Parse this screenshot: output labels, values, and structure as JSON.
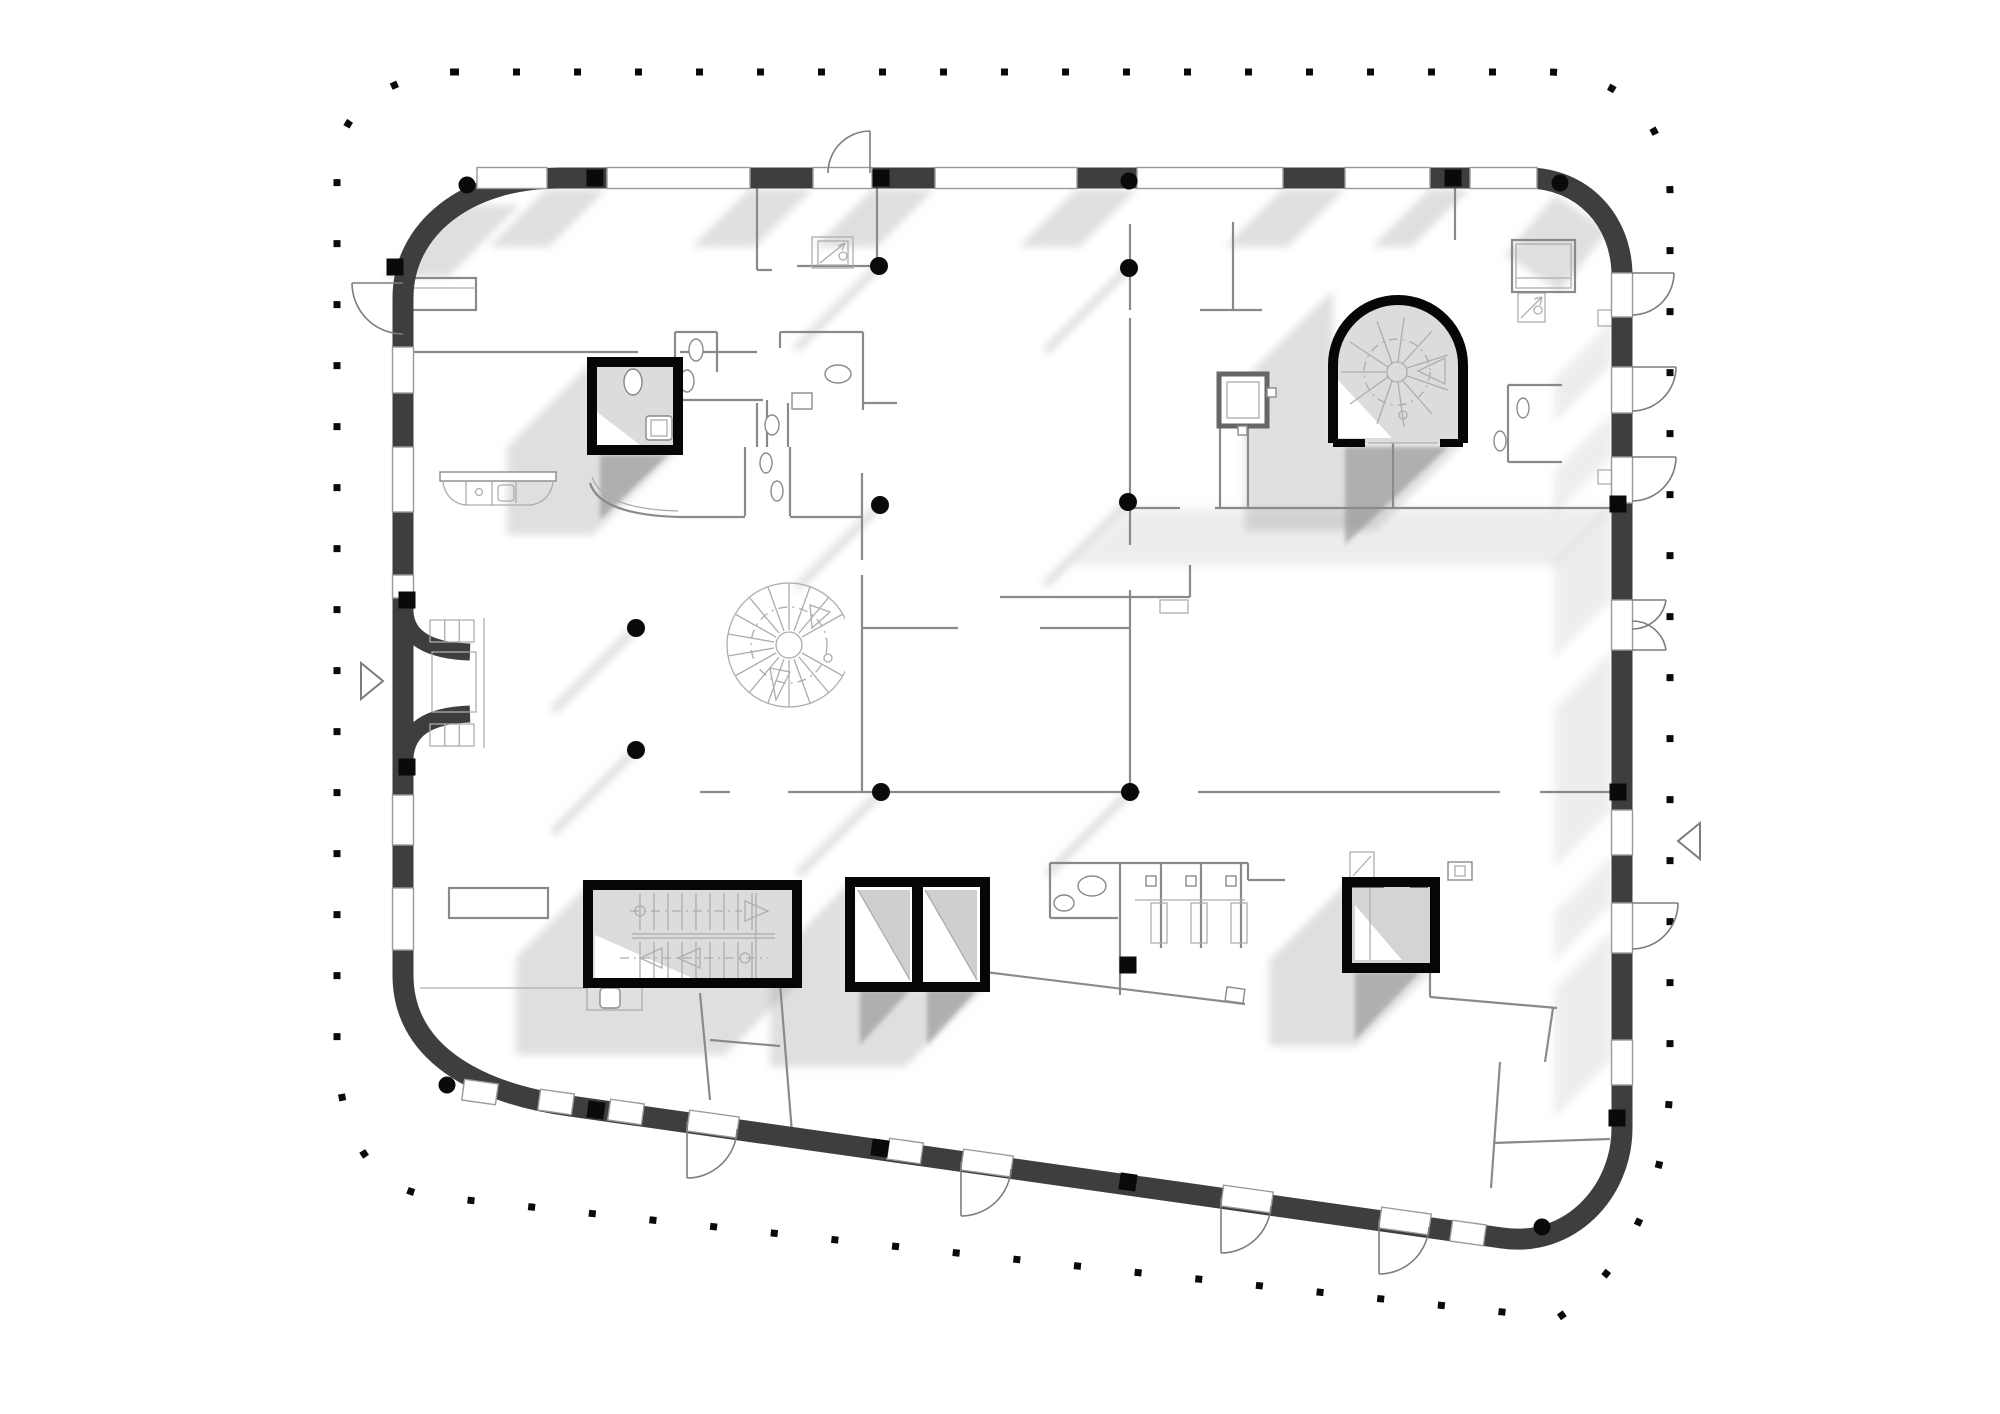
{
  "canvas": {
    "viewBox": "0 0 2000 1414",
    "width": 2000,
    "height": 1414,
    "background": "#ffffff"
  },
  "palette": {
    "outer_wall": "#3e3e3e",
    "core_outline": "#060606",
    "partition": "#8a8a8a",
    "light_line": "#adadad",
    "shadow": "#8f8f8f",
    "interior_fill": "#dcdcdc",
    "window_fill": "#ffffff",
    "boundary_dot": "#0a0a0a",
    "background": "#ffffff"
  },
  "drawing": {
    "type": "architectural floor plan",
    "text_labels": [],
    "features": [
      {
        "name": "site-boundary",
        "description": "dotted rounded-rectangle property/roof line of small square black dots surrounding the plan"
      },
      {
        "name": "building-shell",
        "description": "thick dark charcoal exterior wall, rounded corners, bottom edge sloping down toward the right"
      },
      {
        "name": "window-openings",
        "description": "white glazing bands with thin gray outlines interrupting the dark exterior wall on all four sides"
      },
      {
        "name": "structural-columns",
        "description": "small solid black squares on the wall line and solid black round columns inside the open plan, each casting a short diagonal shadow to lower-left"
      },
      {
        "name": "entrance-recess",
        "description": "curved recessed main entrance on the left wall with glazed vestibule and three-pane sidelights"
      },
      {
        "name": "entry-markers",
        "description": "open triangle direction markers outside the left wall and outside the right wall"
      },
      {
        "name": "reception-desk",
        "description": "counter with rounded front and internal compartments near the top-left, inside the entrance zone"
      },
      {
        "name": "central-spiral-stair",
        "description": "large light-gray spiral stair with radial treads, dashed walk line and arrows near the plan centre"
      },
      {
        "name": "arched-stair-core",
        "description": "bold black arch-topped core at top right containing a spiral stair with arrow"
      },
      {
        "name": "straight-stair-core",
        "description": "bold black rectangular stair core at lower left with two straight flights, tread lines, arrows and walk lines"
      },
      {
        "name": "elevator-core-double",
        "description": "bold black double elevator shaft at bottom centre with centre mullion and diagonal light/dark shaft shading"
      },
      {
        "name": "elevator-core-single",
        "description": "bold black single elevator shaft at bottom right with gray cab fill"
      },
      {
        "name": "wc-core",
        "description": "bold black small WC room at upper left with toilet and basin"
      },
      {
        "name": "north-wc-cluster",
        "description": "group of toilet rooms with ovals (WCs) and small basins right of the wc-core near the top"
      },
      {
        "name": "south-wc-cluster",
        "description": "row of three toilet stalls plus accessible WC at bottom centre-right"
      },
      {
        "name": "service-shafts",
        "description": "small square shafts with diagonal arrow symbols (top centre, top right, above the single elevator) and a framed square shaft below the arch core"
      },
      {
        "name": "door-swings",
        "description": "quarter-circle door swing arcs on the top wall, right wall (including a double door) and four along the sloped bottom wall"
      },
      {
        "name": "cast-shadows",
        "description": "soft gray 45-degree shadows thrown down-and-left from wall segments, cores and free columns"
      }
    ]
  }
}
